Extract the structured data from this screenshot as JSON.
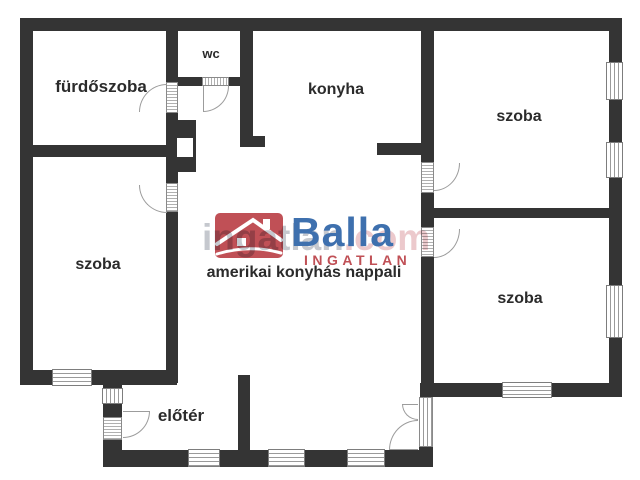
{
  "floorplan": {
    "rooms": [
      {
        "id": "bathroom",
        "label": "fürdőszoba"
      },
      {
        "id": "wc",
        "label": "wc"
      },
      {
        "id": "kitchen",
        "label": "konyha"
      },
      {
        "id": "room-top-right",
        "label": "szoba"
      },
      {
        "id": "room-left",
        "label": "szoba"
      },
      {
        "id": "room-bottom-right",
        "label": "szoba"
      },
      {
        "id": "living-room",
        "label": "amerikai konyhás nappali"
      },
      {
        "id": "hall",
        "label": "előtér"
      }
    ],
    "watermark": {
      "brand": "Balla",
      "brand_sub": "INGATLAN",
      "site_name": "ingatlan",
      "site_tld": ".com"
    },
    "colors": {
      "wall": "#343434",
      "brand_red": "#c05056",
      "brand_blue": "#3e70ae",
      "watermark_gray": "#c5c8ce",
      "watermark_pink": "#ecc9cc",
      "label_text": "#2b2b2b"
    }
  }
}
